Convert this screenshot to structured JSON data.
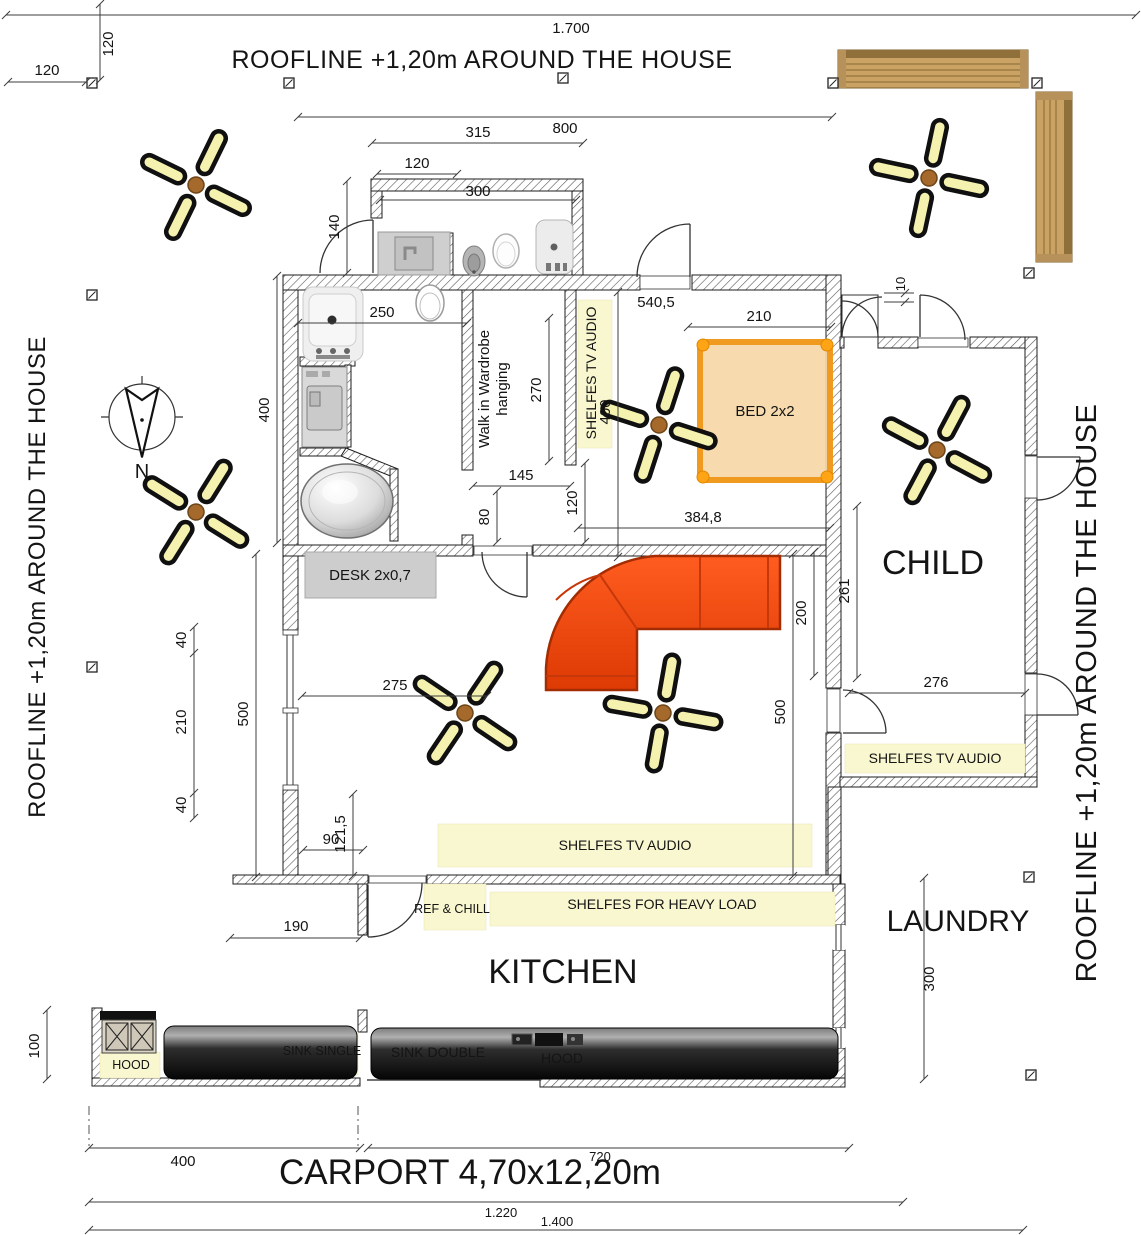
{
  "titles": {
    "top": "ROOFLINE +1,20m AROUND THE HOUSE",
    "left": "ROOFLINE +1,20m AROUND THE HOUSE",
    "right": "ROOFLINE +1,20m AROUND THE HOUSE"
  },
  "rooms": {
    "child": "CHILD",
    "kitchen": "KITCHEN",
    "laundry": "LAUNDRY",
    "carport": "CARPORT  4,70x12,20m",
    "wardrobe_line1": "Walk in Wardrobe",
    "wardrobe_line2": "hanging"
  },
  "labels": {
    "bed": "BED 2x2",
    "desk": "DESK 2x0,7",
    "shelves_bedroom": "SHELFES TV AUDIO",
    "shelves_child": "SHELFES TV AUDIO",
    "shelves_living": "SHELFES TV AUDIO",
    "shelves_heavy": "SHELFES FOR HEAVY LOAD",
    "ref_chill": "REF & CHILL",
    "hood_left": "HOOD",
    "hood_right": "HOOD",
    "sink_single": "SINK SINGLE",
    "sink_double": "SINK DOUBLE"
  },
  "compass": {
    "north": "N"
  },
  "dims": {
    "overall_top": "1.700",
    "offset_top_v": "120",
    "offset_top_h": "120",
    "north_wing": "800",
    "ext_width": "315",
    "ext_part": "120",
    "ext_inner": "300",
    "ext_depth": "140",
    "bath_width": "250",
    "west_wall": "400",
    "wardrobe_depth": "270",
    "wardrobe_opening": "145",
    "hall_gap": "80",
    "bedroom_total": "540,5",
    "bed_width": "210",
    "bedroom_shelf": "400",
    "bed_gap": "120",
    "bedroom_width": "384,8",
    "child_depth": "261",
    "child_width": "276",
    "door_gap": "10",
    "sofa_depth": "200",
    "living_east": "500",
    "living_width": "275",
    "win_a": "40",
    "win_b": "210",
    "win_c": "40",
    "living_west": "500",
    "porch": "90",
    "porch_depth": "121,5",
    "kitchen_offset": "190",
    "laundry_depth": "300",
    "bbq_depth": "100",
    "carport_a": "400",
    "carport_b": "720",
    "carport_total": "1.220",
    "overall_bottom": "1.400"
  },
  "colors": {
    "bed_accent": "#f59d28",
    "sofa": "#e8470e",
    "shelf_band": "#f9f7cf",
    "wood": "#c9a264",
    "counter": "#1b1b1b",
    "fan_blade": "#f5f2b0"
  }
}
